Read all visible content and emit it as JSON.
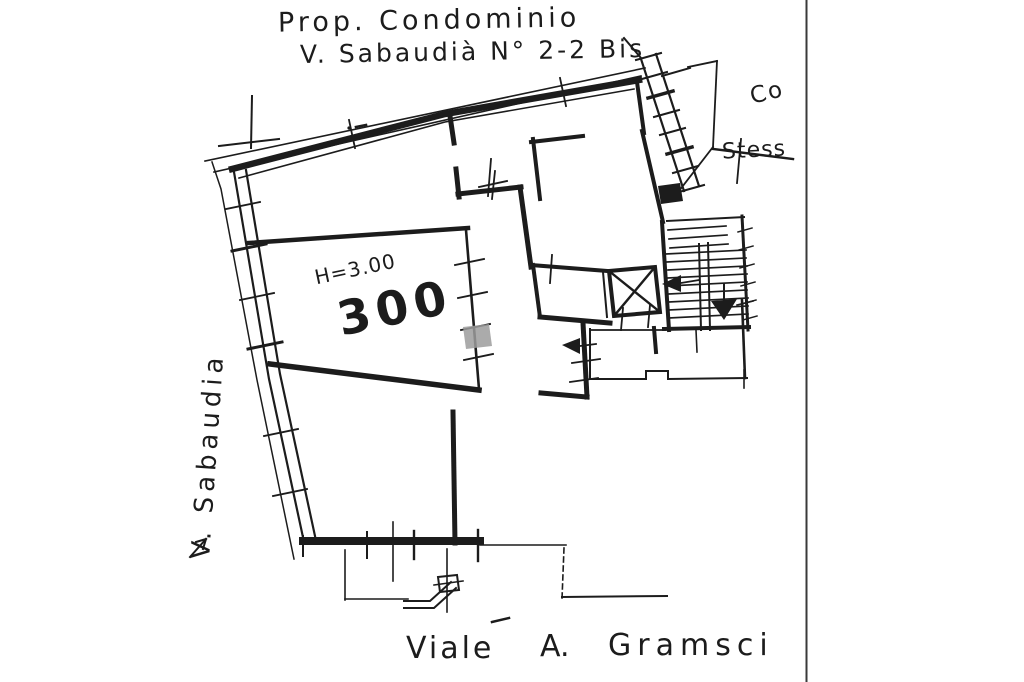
{
  "document": {
    "type": "scanned cadastral floor plan",
    "title_line1": "Prop. Condominio",
    "title_line2": "V. Sabaudià N° 2-2 Bis"
  },
  "plan": {
    "room": {
      "height_label": "H=3.00",
      "area_label": "300"
    },
    "streets": {
      "left": "V. Sabaudia",
      "bottom": {
        "word1": "Viale",
        "word2": "A.",
        "word3": "Gramsci"
      }
    },
    "adjacent_property": {
      "line1": "Co",
      "line2": "Stess"
    },
    "features": [
      "elevator-shaft",
      "internal-staircase",
      "exterior-staircase",
      "stairs-down-arrow",
      "entrance-arrow",
      "window-ticks",
      "pencil-mark"
    ]
  },
  "colors": {
    "ink": "#1c1c1c",
    "paper": "#ffffff",
    "pencil_mark": "#9c9c9c",
    "scan_edge": "#3a3a3a"
  }
}
